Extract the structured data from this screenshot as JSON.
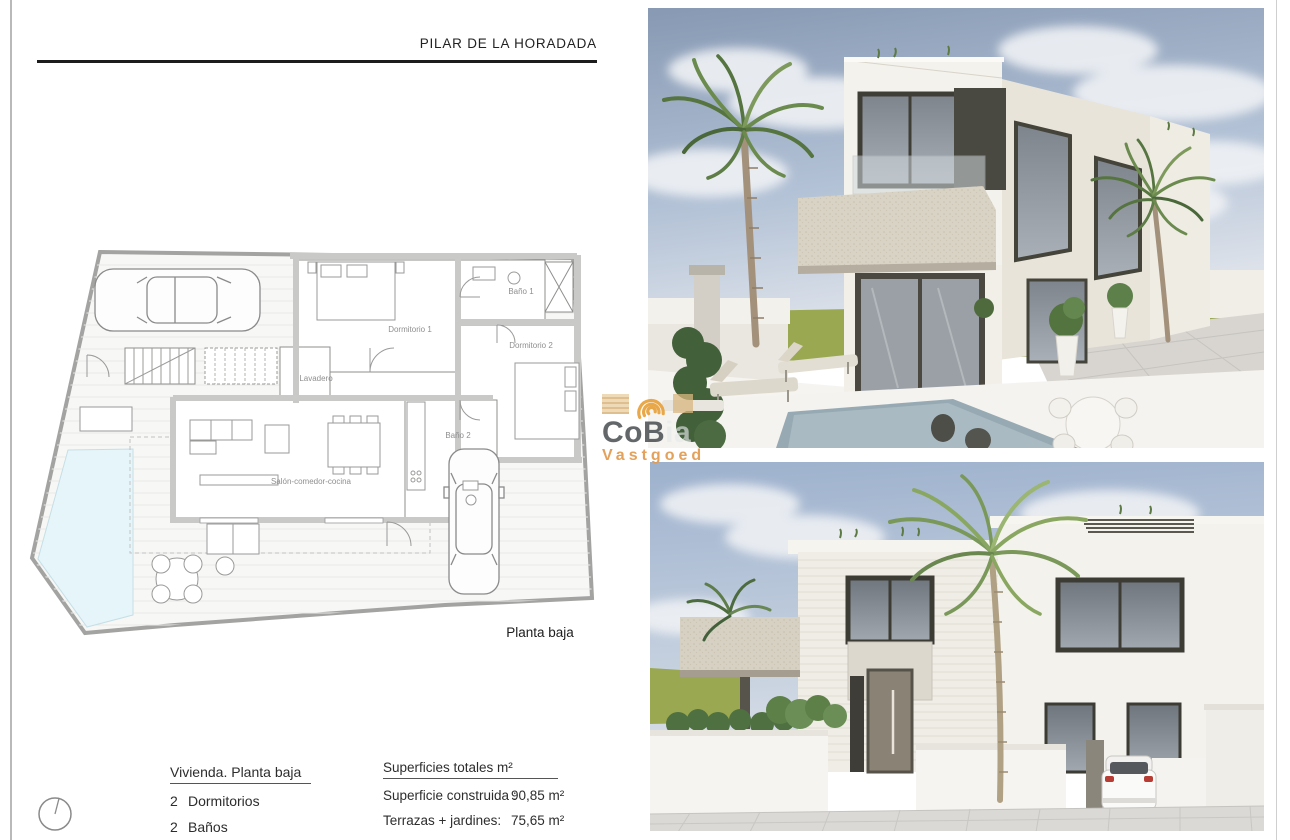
{
  "page": {
    "title": "PILAR DE LA HORADADA"
  },
  "floor_plan": {
    "caption": "Planta baja",
    "rooms": {
      "dormitorio1": "Dormitorio 1",
      "bano1": "Baño 1",
      "dormitorio2": "Dormitorio 2",
      "bano2": "Baño 2",
      "lavadero": "Lavadero",
      "salon": "Salón-comedor-cocina"
    }
  },
  "details": {
    "vivienda": {
      "heading": "Vivienda. Planta baja",
      "items": [
        {
          "qty": "2",
          "label": "Dormitorios"
        },
        {
          "qty": "2",
          "label": "Baños"
        }
      ]
    },
    "superficies": {
      "heading": "Superficies totales m²",
      "rows": [
        {
          "label": "Superficie construida :",
          "value": "90,85 m²"
        },
        {
          "label": "Terrazas + jardines:",
          "value": "75,65 m²"
        }
      ]
    }
  },
  "watermark": {
    "name_dark": "CoB",
    "name_light": "ia",
    "subtitle": "Vastgoed",
    "accent_color": "#E29A4F"
  },
  "colors": {
    "pool_blue": "#E6F5F9",
    "grass_green": "#9AA851",
    "sky_blue": "#A9BCD8",
    "rule_black": "#1C1C1C"
  }
}
